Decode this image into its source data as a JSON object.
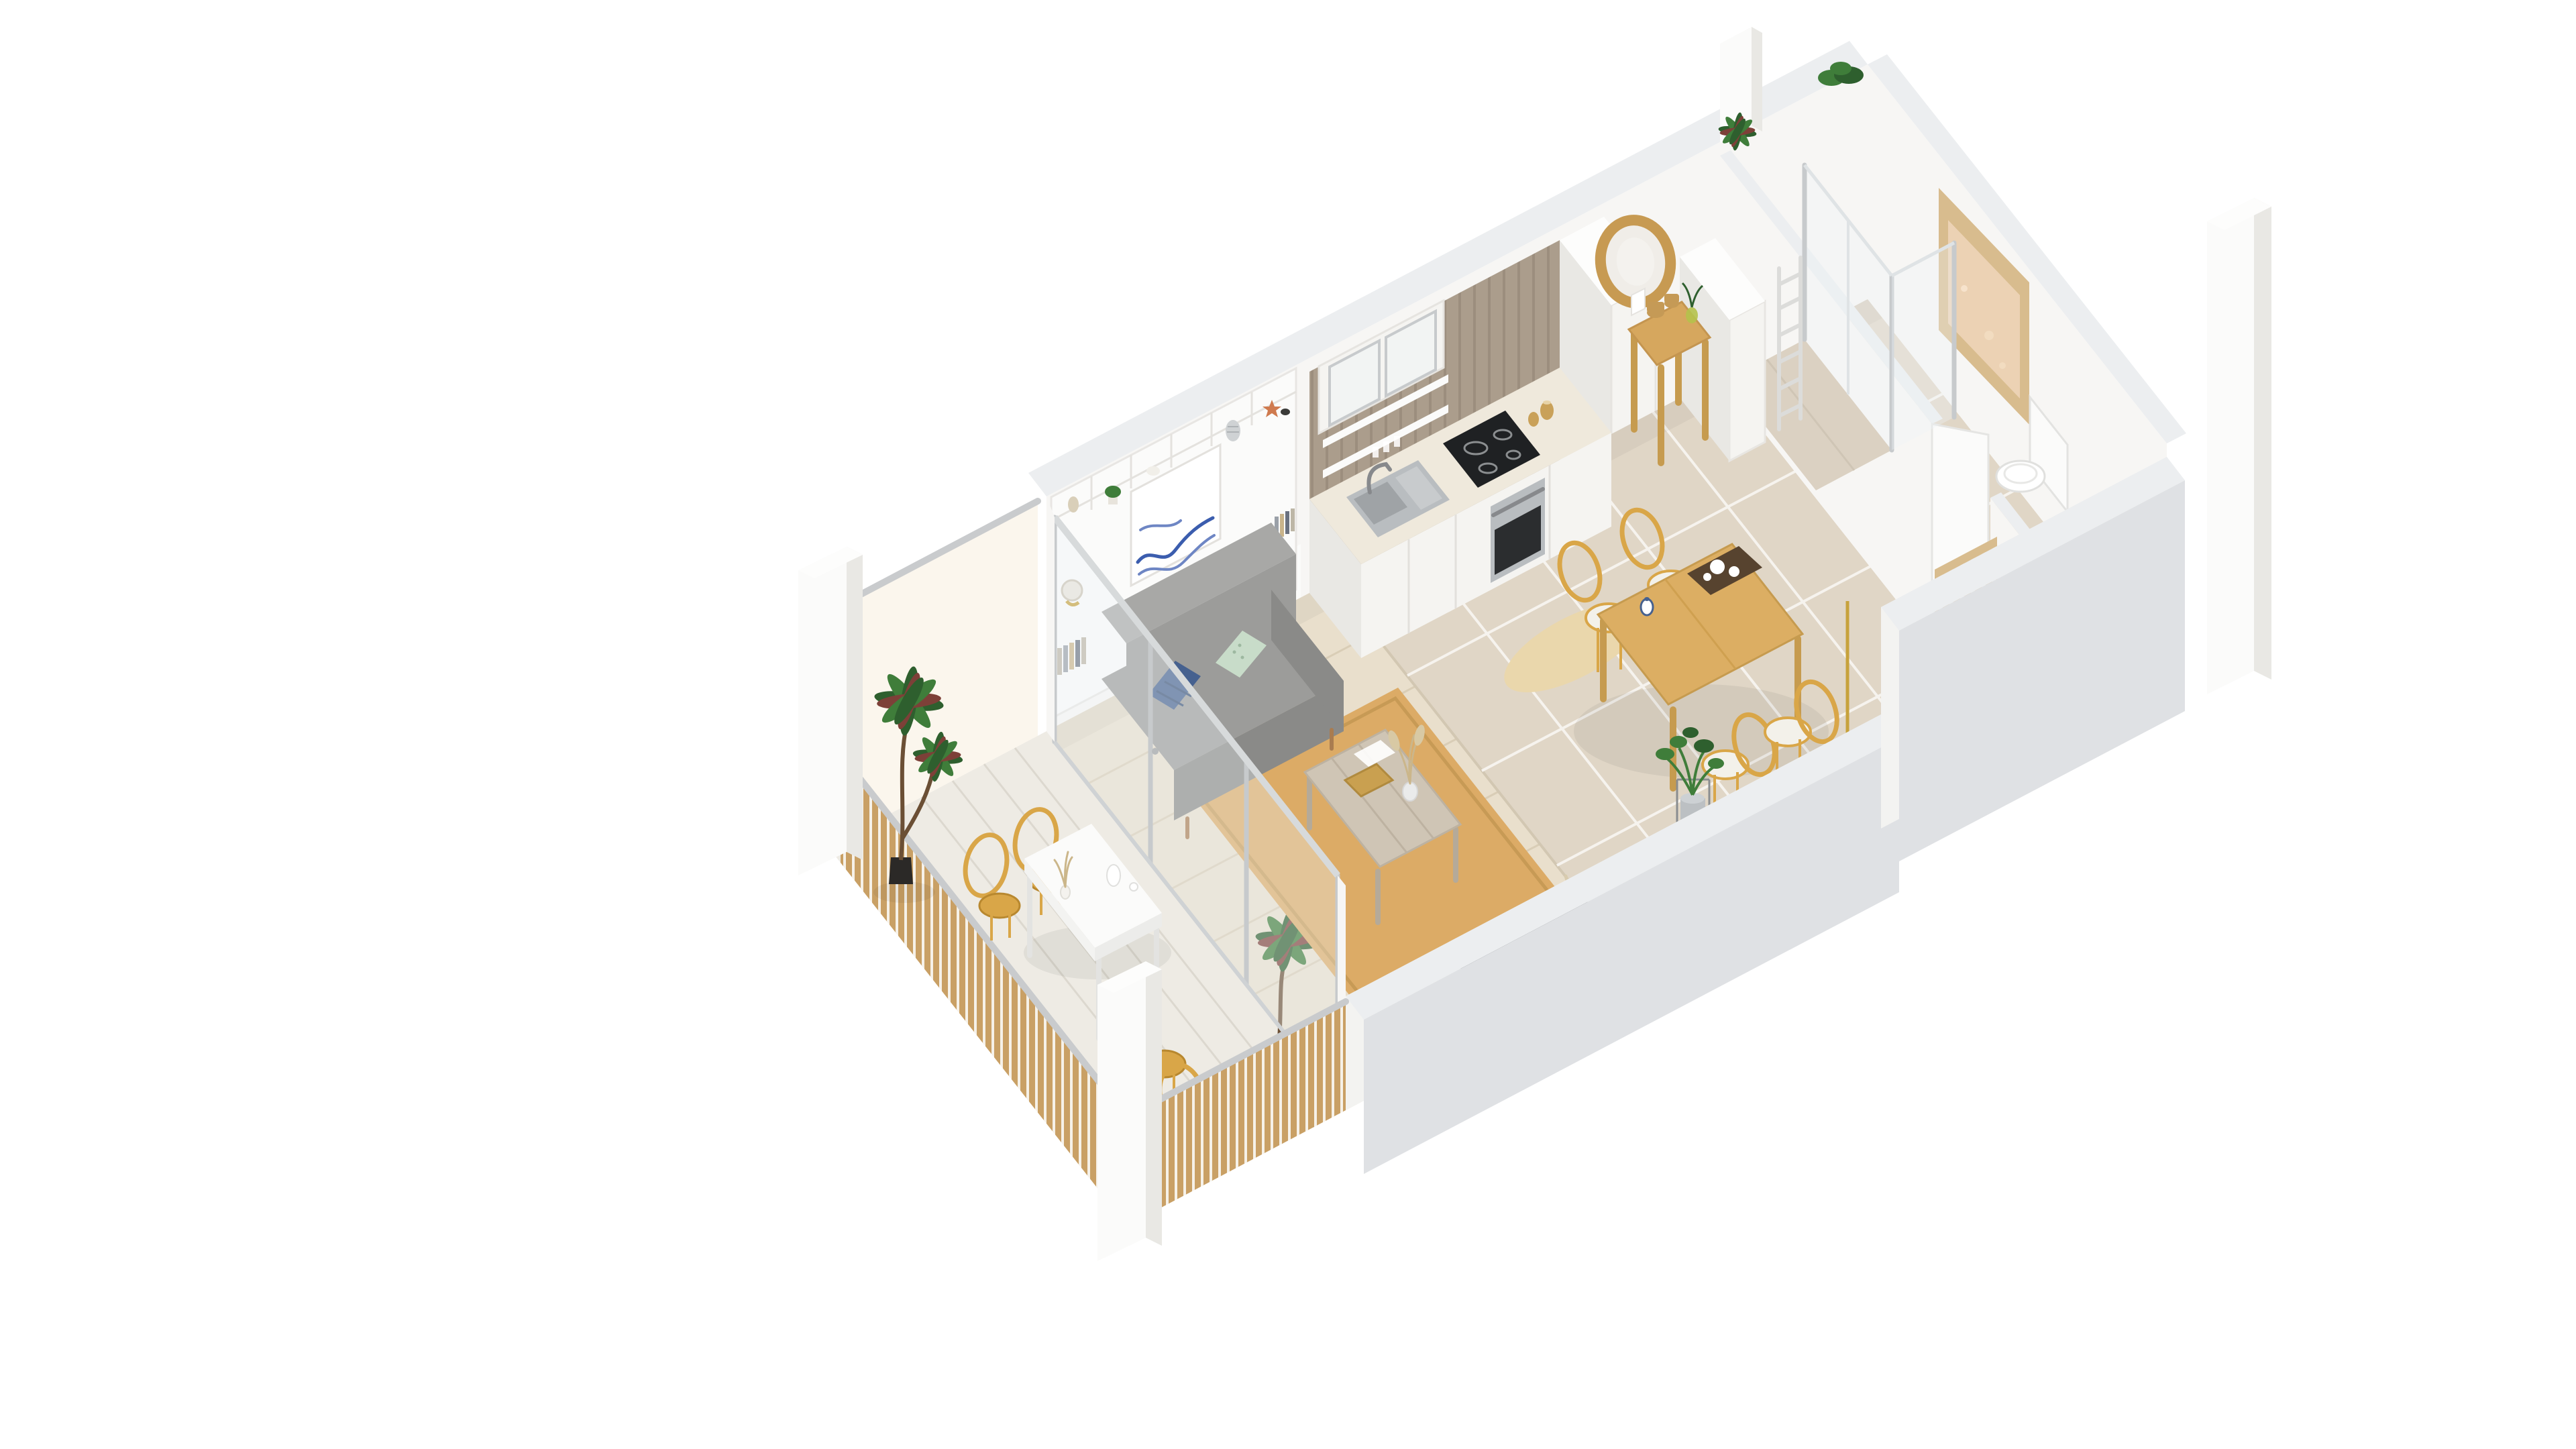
{
  "scene": {
    "type": "3d-floor-plan-render",
    "view": "isometric cutaway from above",
    "background": "#ffffff",
    "apartment": "studio apartment with open living/kitchen/dining, hallway, bathroom and balcony"
  },
  "palette": {
    "bg": "#ffffff",
    "wall_face": "#f7f6f4",
    "wall_top": "#fdfdfc",
    "wall_cut": "#eceef0",
    "wall_outer": "#dfe1e4",
    "floor_wood": "#e9dfcc",
    "floor_wood_line": "#d9cdb6",
    "floor_tile": "#e0d6c6",
    "tile_grout": "#f6f3ee",
    "balcony_floor": "#eeebe4",
    "balcony_floor_line": "#dcd8cf",
    "railing_wood": "#c9a065",
    "railing_cap": "#c9cbcd",
    "glass": "#eef3f5",
    "glass_frame": "#c7cacc",
    "privacy_glass": "#fbf6ec",
    "rug_jute": "#dcab66",
    "rug_oval": "#ead7ac",
    "sofa": "#9c9c9a",
    "sofa_dark": "#8a8a88",
    "pillow_blue": "#46618f",
    "pillow_mint": "#c8dcc9",
    "art_blue": "#3b5dae",
    "table_wood": "#dcae63",
    "chair_rattan": "#d9a648",
    "seat_white": "#f3f1ea",
    "coffee_wood": "#cfc5b5",
    "tray_gold": "#c9a050",
    "plank_wood": "#ab9d8c",
    "plank_line": "#8f8172",
    "counter_top": "#efe9dc",
    "cabinet_white": "#f5f4f1",
    "steel": "#b9bdc0",
    "steel_dark": "#87898c",
    "cooktop": "#1f2123",
    "oven_glass": "#2b2d2f",
    "jar_amber": "#c9a159",
    "mirror_rattan": "#c79a52",
    "console_wood": "#d6a75e",
    "basket": "#c59a56",
    "plant_green": "#3f7d3a",
    "plant_dark": "#2e5f2e",
    "palm_red": "#7d4038",
    "pot_black": "#2b2927",
    "pot_zinc": "#bcc0c3",
    "window_frame": "#d8bc8e",
    "window_glass": "#ecd2b4",
    "tv_dark": "#3a3c3e",
    "lamp_gold": "#c7a23c"
  },
  "rooms": [
    {
      "id": "balcony",
      "name": "Balcony",
      "floor": "white wood planks",
      "items": [
        "wood slat railing with metal cap",
        "frosted privacy glass screen",
        "white outdoor dining table",
        "3 rattan chairs",
        "2 potted palm plants",
        "white carafe and glass",
        "vase with dried sprigs",
        "white corner pillars"
      ]
    },
    {
      "id": "living-room",
      "name": "Living room",
      "floor": "light oak planks",
      "items": [
        "gray fabric sofa",
        "navy patterned cushion",
        "mint dotted cushion",
        "built-in white shelving wall",
        "blue line-art wall print",
        "globe on shelf",
        "books on shelves",
        "jute area rug",
        "whitewashed wood coffee table",
        "gold decorative tray",
        "magazine",
        "glass vase with pampas grass",
        "wall-mounted TV",
        "driftwood branch decor",
        "white panel radiator",
        "sliding glass doors to balcony"
      ]
    },
    {
      "id": "kitchen",
      "name": "Kitchen",
      "floor": "beige tiles",
      "items": [
        "rustic wood plank backsplash",
        "white base cabinets",
        "stainless double sink",
        "chrome faucet",
        "black induction cooktop",
        "built-in stainless oven",
        "glass-front upper cabinet",
        "open shelves with glassware",
        "amber storage jars",
        "tall white cabinet column",
        "oval jute mat"
      ]
    },
    {
      "id": "dining-area",
      "name": "Dining area",
      "floor": "beige tiles",
      "items": [
        "light oak dining table",
        "4 rattan bistro chairs with white seats",
        "serving tray with white dishes",
        "blue-and-white ceramic vase",
        "potted plant in metal stand",
        "black floor lamp with brass stem"
      ]
    },
    {
      "id": "hallway",
      "name": "Hallway / entry",
      "floor": "beige tiles",
      "items": [
        "round rattan mirror",
        "oak console table",
        "2 woven baskets",
        "green glass vase with sprig",
        "white leaning card",
        "white storage column",
        "white interior door",
        "wood slat entry niche"
      ]
    },
    {
      "id": "bathroom",
      "name": "Bathroom",
      "floor": "beige tiles",
      "items": [
        "frosted amber window with wood frame",
        "walk-in shower with glass partition",
        "white towel ladder radiator",
        "white toilet",
        "white washbasin counter with chrome faucet",
        "partition wall with door opening"
      ]
    }
  ],
  "exterior": {
    "items": [
      "white structural pillars",
      "green plants on wall tops",
      "gray cutaway wall sections",
      "detached facade pillar"
    ]
  }
}
